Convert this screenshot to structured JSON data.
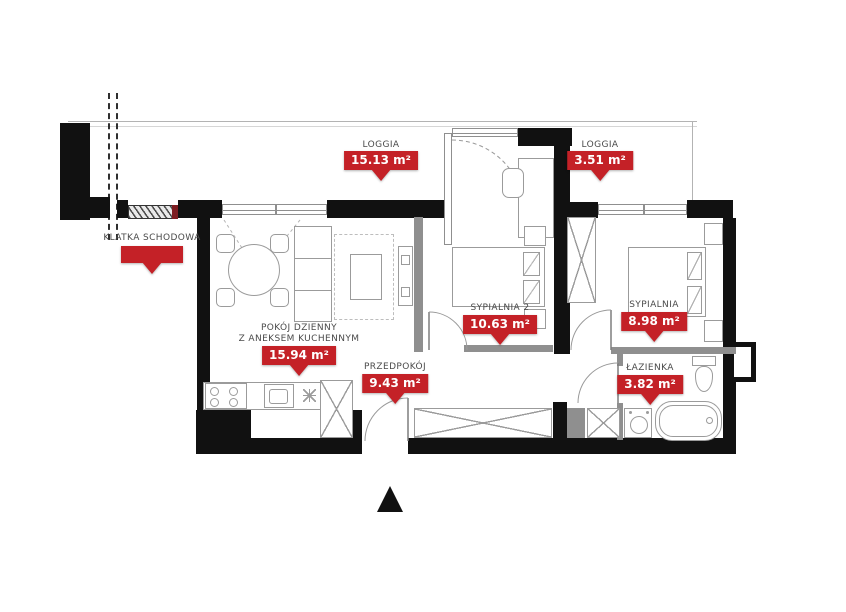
{
  "rooms": {
    "stairwell": {
      "name": "KLATKA SCHODOWA",
      "area": ""
    },
    "loggia_large": {
      "name": "LOGGIA",
      "area": "15.13 m²"
    },
    "loggia_small": {
      "name": "LOGGIA",
      "area": "3.51 m²"
    },
    "living_room": {
      "name": "POKÓJ DZIENNY",
      "name2": "Z ANEKSEM KUCHENNYM",
      "area": "15.94 m²"
    },
    "hallway": {
      "name": "PRZEDPOKÓJ",
      "area": "9.43 m²"
    },
    "bedroom_2": {
      "name": "SYPIALNIA 2",
      "area": "10.63 m²"
    },
    "bedroom": {
      "name": "SYPIALNIA",
      "area": "8.98 m²"
    },
    "bathroom": {
      "name": "ŁAZIENKA",
      "area": "3.82 m²"
    }
  },
  "colors": {
    "wall": "#111111",
    "partition": "#8f8f8f",
    "accent_red": "#c42127",
    "entrance_red": "#7d1d22",
    "line": "#b3b3b3",
    "furniture_line": "#9b9b9b",
    "text": "#4a4a4a"
  }
}
